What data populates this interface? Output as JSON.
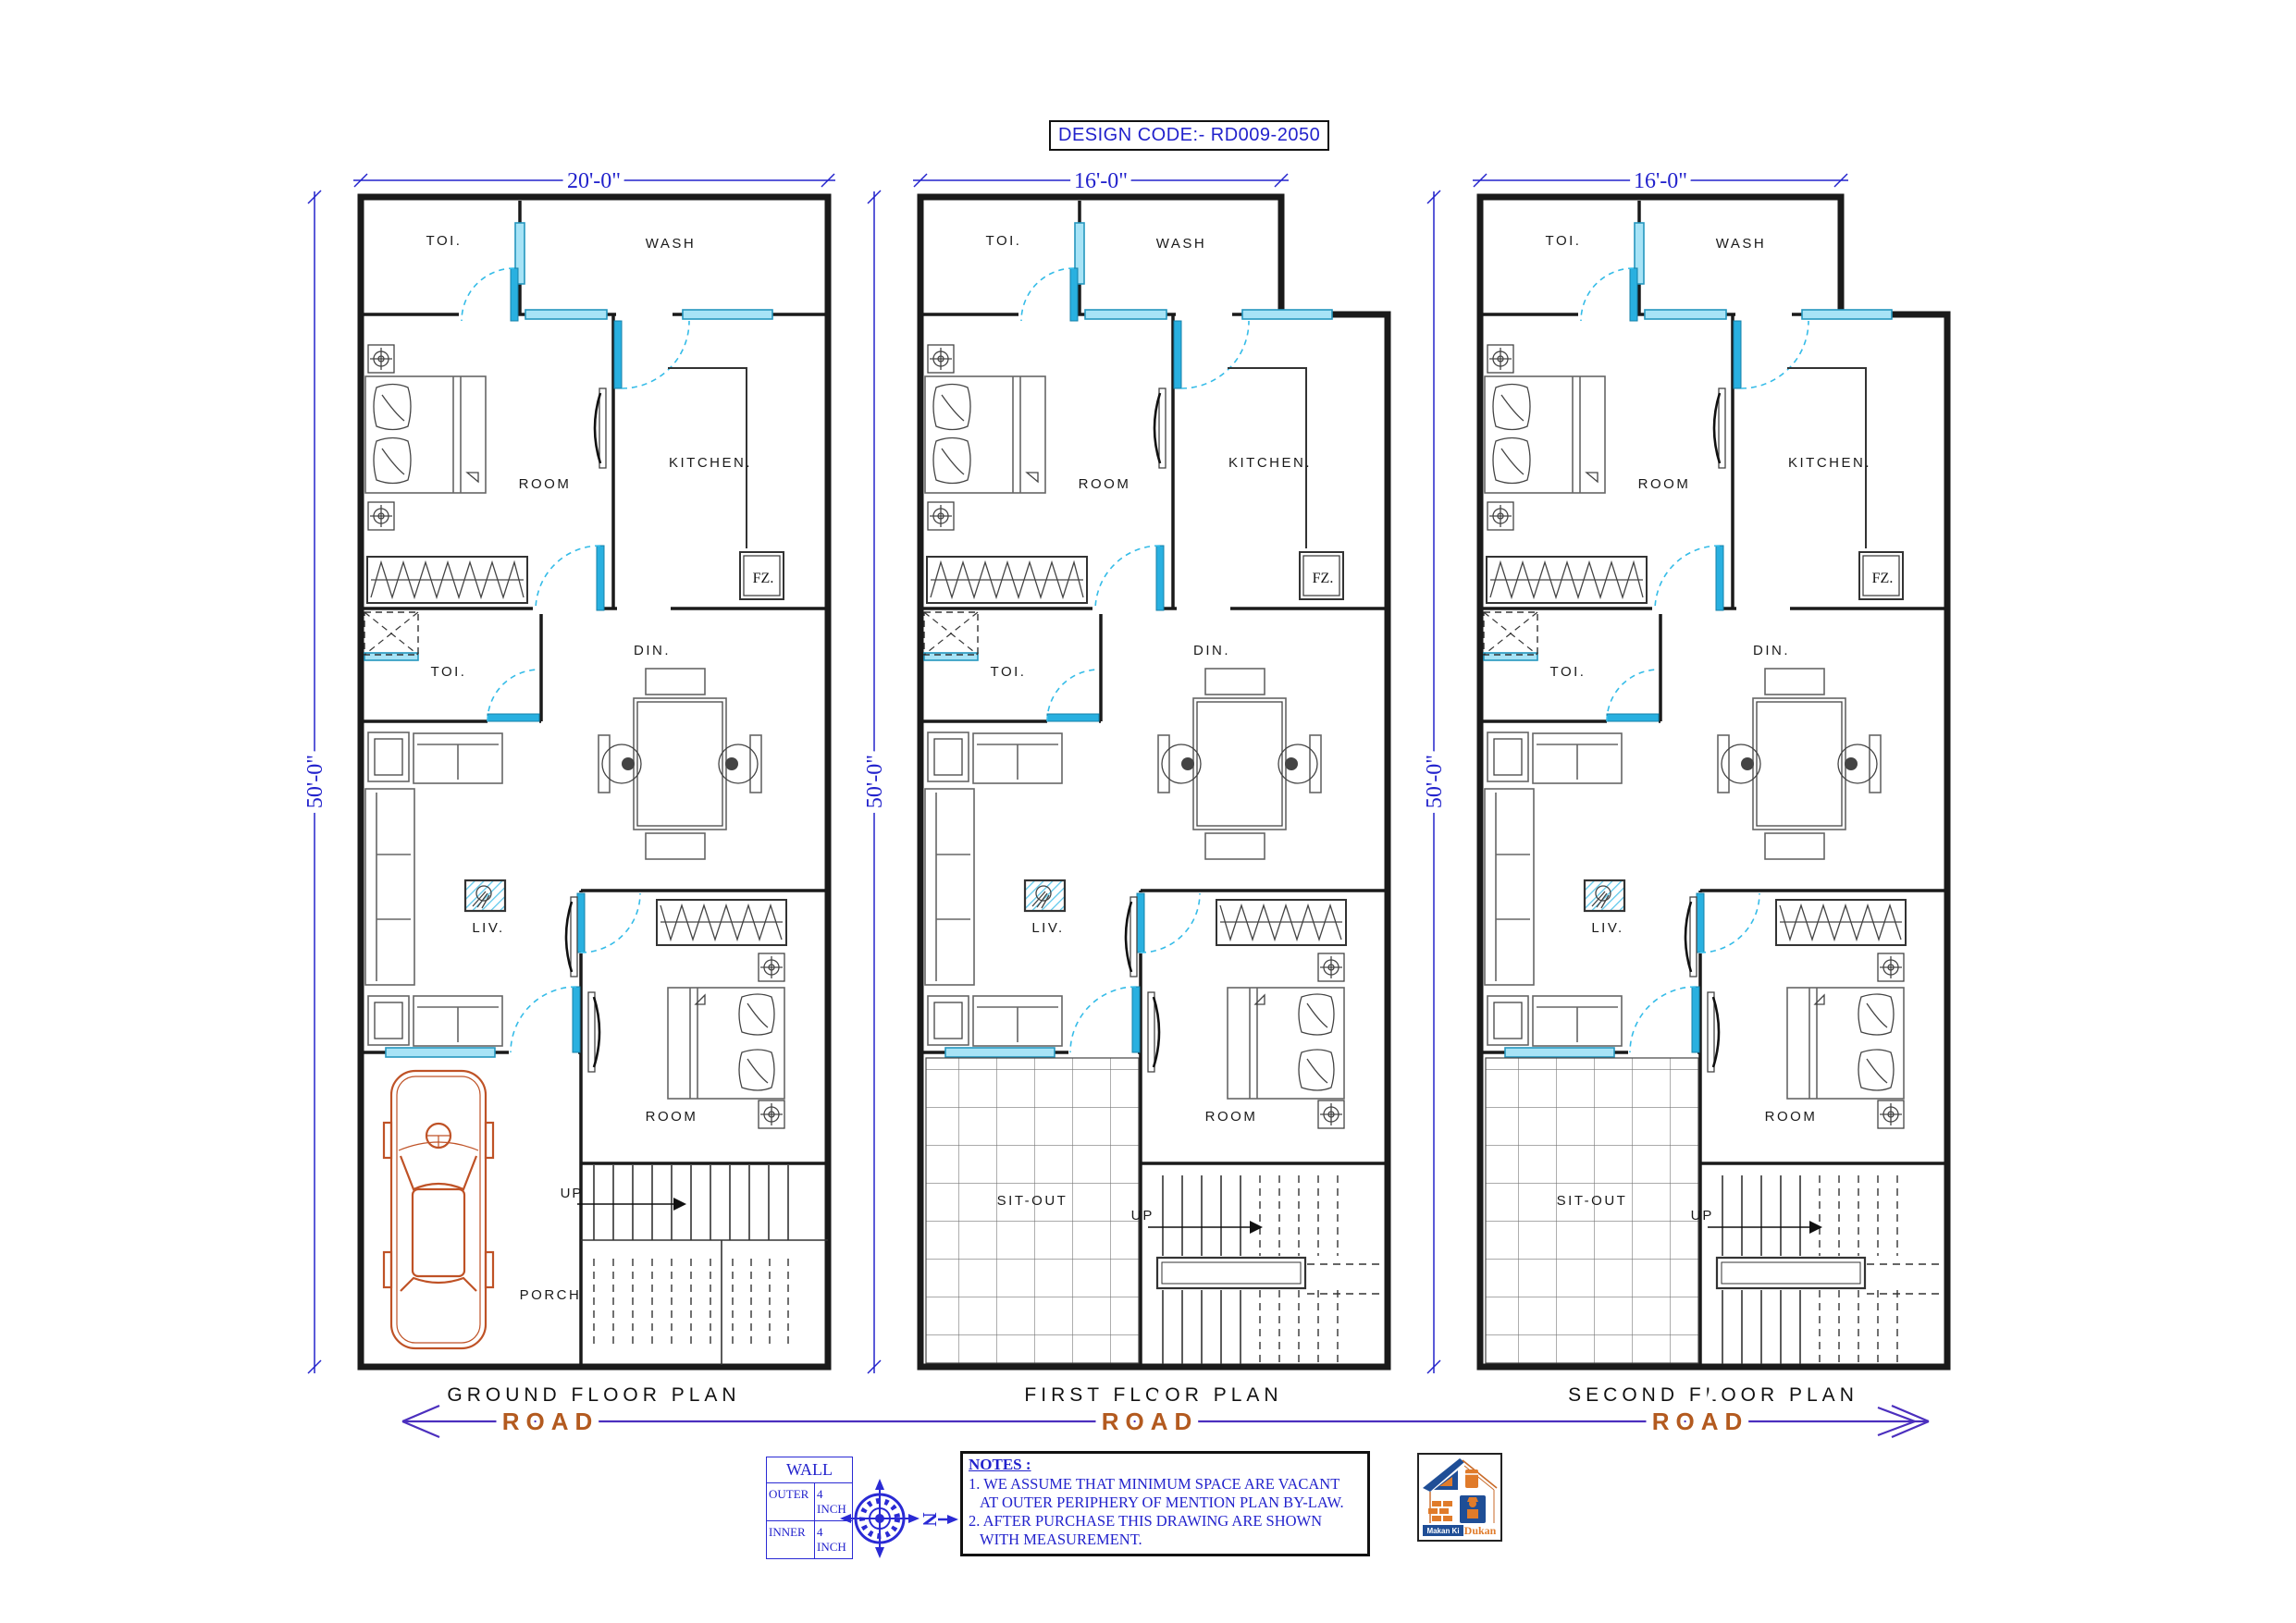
{
  "design_code": "DESIGN CODE:- RD009-2050",
  "rooms": {
    "toi": "TOI.",
    "wash": "WASH",
    "bedroom": "ROOM",
    "kitchen": "KITCHEN.",
    "freezer": "FZ.",
    "dining": "DIN.",
    "toi2": "TOI.",
    "living": "LIV.",
    "bedroom2": "ROOM",
    "up": "UP",
    "porch": "PORCH",
    "sitout": "SIT-OUT"
  },
  "plans": [
    {
      "title": "GROUND FLOOR PLAN",
      "width_dim": "20'-0\"",
      "height_dim": "50'-0\"",
      "road_label": "ROAD"
    },
    {
      "title": "FIRST FLOOR PLAN",
      "width_dim": "16'-0\"",
      "height_dim": "50'-0\"",
      "road_label": "ROAD"
    },
    {
      "title": "SECOND FLOOR PLAN",
      "width_dim": "16'-0\"",
      "height_dim": "50'-0\"",
      "road_label": "ROAD"
    }
  ],
  "legend": {
    "wall_table": {
      "title": "WALL",
      "rows": [
        {
          "name": "OUTER",
          "value": "4 INCH"
        },
        {
          "name": "INNER",
          "value": "4 INCH"
        }
      ]
    },
    "compass_letter": "N",
    "notes": {
      "title": "NOTES :",
      "lines": [
        "1. WE ASSUME THAT MINIMUM SPACE ARE VACANT",
        "AT OUTER PERIPHERY OF MENTION PLAN BY-LAW.",
        "2. AFTER PURCHASE THIS DRAWING ARE SHOWN",
        "WITH  MEASUREMENT."
      ]
    }
  },
  "logo": {
    "brand_top": "Makan Ki",
    "brand_bottom": "Dukan"
  },
  "colors": {
    "dimension_blue": "#2222cc",
    "window_cyan": "#35bce8",
    "wall_black": "#1a1a1a",
    "car_orange": "#bf5226",
    "road_line_purple": "#4b2fbe",
    "road_text_orange": "#b35a1f",
    "logo_blue": "#1f4e96",
    "logo_orange": "#e07b2a"
  }
}
